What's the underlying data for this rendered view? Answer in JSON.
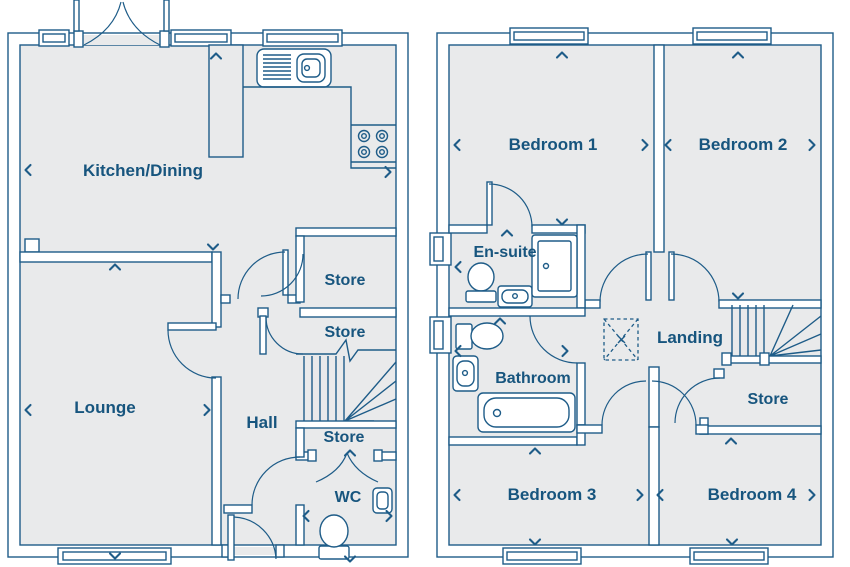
{
  "ground_floor": {
    "kitchen": "Kitchen/Dining",
    "lounge": "Lounge",
    "hall": "Hall",
    "store_top": "Store",
    "store_middle": "Store",
    "store_under_stairs": "Store",
    "wc": "WC"
  },
  "first_floor": {
    "bedroom1": "Bedroom 1",
    "bedroom2": "Bedroom 2",
    "ensuite": "En-suite",
    "bathroom": "Bathroom",
    "landing": "Landing",
    "store": "Store",
    "bedroom3": "Bedroom 3",
    "bedroom4": "Bedroom 4"
  },
  "colors": {
    "line": "#1e5c88",
    "label_text": "#17557e",
    "floor_fill": "#e9eaeb",
    "background": "#ffffff"
  }
}
